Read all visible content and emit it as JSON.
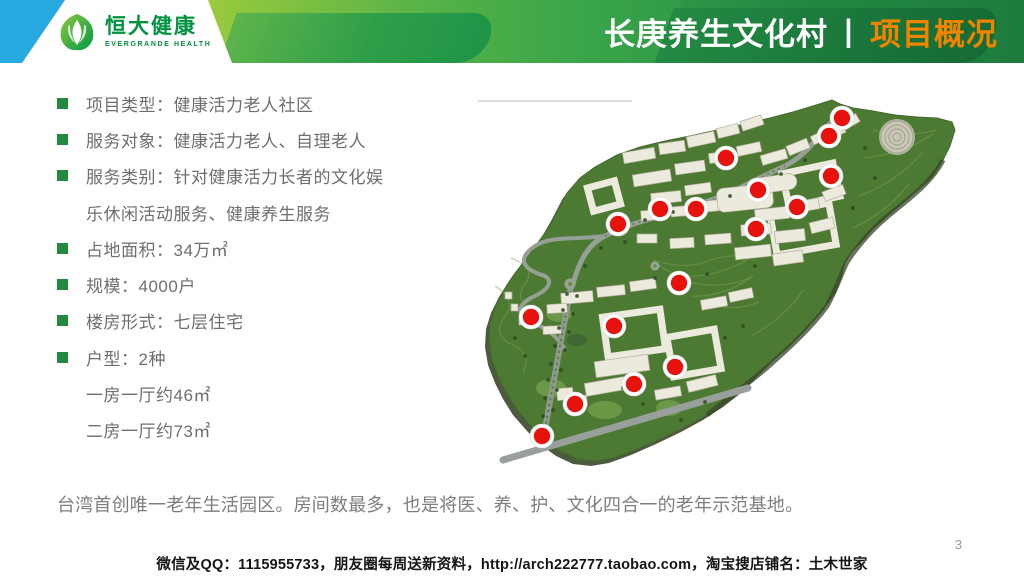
{
  "header": {
    "logo": {
      "brand_cn": "恒大健康",
      "brand_en": "EVERGRANDE HEALTH"
    },
    "title": {
      "main": "长庚养生文化村",
      "separator": "丨",
      "section": "项目概况"
    }
  },
  "bullets": [
    {
      "bullet": true,
      "text": "项目类型：健康活力老人社区"
    },
    {
      "bullet": true,
      "text": "服务对象：健康活力老人、自理老人"
    },
    {
      "bullet": true,
      "text": "服务类别：针对健康活力长者的文化娱"
    },
    {
      "bullet": false,
      "text": "乐休闲活动服务、健康养生服务"
    },
    {
      "bullet": true,
      "text": "占地面积：34万㎡"
    },
    {
      "bullet": true,
      "text": "规模：4000户"
    },
    {
      "bullet": true,
      "text": "楼房形式：七层住宅"
    },
    {
      "bullet": true,
      "text": "户型：2种"
    },
    {
      "bullet": false,
      "text": "一房一厅约46㎡"
    },
    {
      "bullet": false,
      "text": "二房一厅约73㎡"
    }
  ],
  "summary": "台湾首创唯一老年生活园区。房间数最多，也是将医、养、护、文化四合一的老年示范基地。",
  "footer": {
    "contact": "微信及QQ：1115955733，朋友圈每周送新资料，http://arch222777.taobao.com，淘宝搜店铺名：土木世家",
    "page_number": "3"
  },
  "map": {
    "description": "aerial-3d-site-plan-with-red-location-markers",
    "marker_color": "#e8120c",
    "markers": [
      {
        "x": 387,
        "y": 30
      },
      {
        "x": 374,
        "y": 48
      },
      {
        "x": 271,
        "y": 70
      },
      {
        "x": 376,
        "y": 88
      },
      {
        "x": 303,
        "y": 102
      },
      {
        "x": 342,
        "y": 119
      },
      {
        "x": 205,
        "y": 121
      },
      {
        "x": 241,
        "y": 121
      },
      {
        "x": 163,
        "y": 136
      },
      {
        "x": 301,
        "y": 141
      },
      {
        "x": 224,
        "y": 195
      },
      {
        "x": 76,
        "y": 229
      },
      {
        "x": 159,
        "y": 238
      },
      {
        "x": 220,
        "y": 279
      },
      {
        "x": 179,
        "y": 296
      },
      {
        "x": 120,
        "y": 316
      },
      {
        "x": 87,
        "y": 348
      }
    ]
  },
  "colors": {
    "accent_orange": "#f08300",
    "brand_green": "#00923f",
    "bullet_green": "#218a3e",
    "header_blue": "#29a9e1"
  }
}
